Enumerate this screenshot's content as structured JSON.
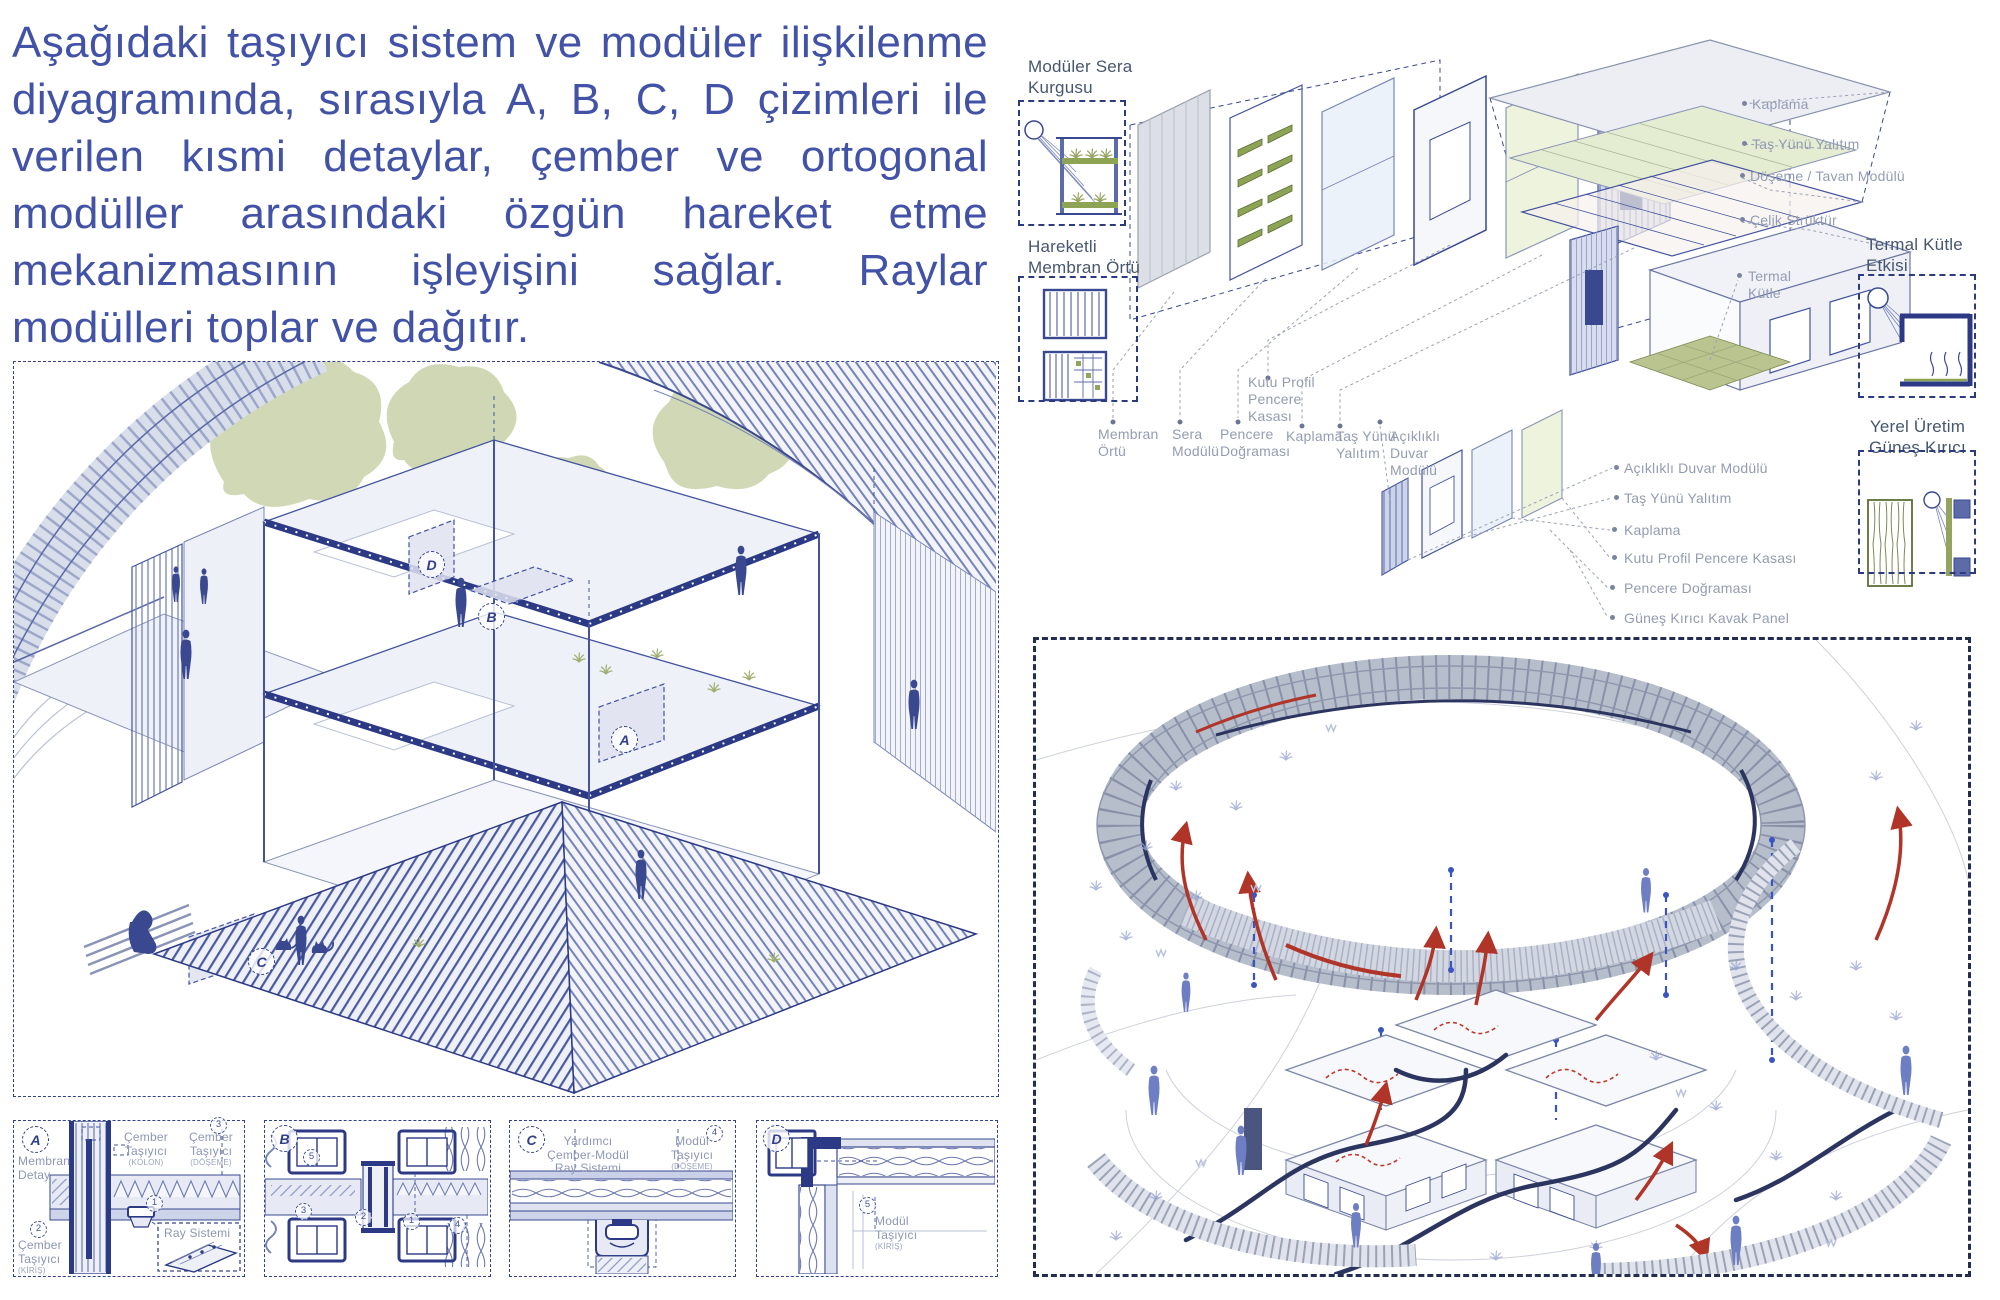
{
  "intro": {
    "text": "Aşağıdaki taşıyıcı sistem ve modüler ilişkilenme diyagramında, sırasıyla A, B, C, D çizimleri ile verilen kısmi detaylar, çember ve ortogonal modüller arasındaki özgün hareket etme mekanizmasının işleyişini sağlar. Raylar modülleri toplar ve dağıtır."
  },
  "left_axo": {
    "markers": {
      "a": "A",
      "b": "B",
      "c": "C",
      "d": "D"
    }
  },
  "detail_numbers": {
    "n1": "1",
    "n2": "2",
    "n3": "3",
    "n4": "4",
    "n5": "5"
  },
  "details": {
    "a": {
      "marker": "A",
      "membran_detay": "Membran Detay",
      "cember": "Çember Taşıyıcı",
      "sub_kolon": "(KOLON)",
      "sub_doseme": "(DÖŞEME)",
      "sub_kiris": "(KİRİŞ)",
      "ray_sistemi": "Ray Sistemi"
    },
    "b": {
      "marker": "B"
    },
    "c": {
      "marker": "C",
      "yardimci": "Yardımcı Çember-Modül Ray Sistemi",
      "modul": "Modül Taşıyıcı",
      "sub_doseme": "(DÖŞEME)"
    },
    "d": {
      "marker": "D",
      "modul": "Modül Taşıyıcı",
      "sub_kiris": "(KİRİŞ)"
    }
  },
  "exploded": {
    "box_sera_title": "Modüler Sera Kurgusu",
    "box_membran_title": "Hareketli Membran Örtü",
    "box_termal_title": "Termal Kütle Etkisi",
    "box_yerel_title": "Yerel Üretim Güneş Kırıcı",
    "bottom_labels": {
      "membran": "Membran Örtü",
      "sera": "Sera Modülü",
      "pencere": "Pencere Doğraması",
      "kutu": "Kutu Profil Pencere Kasası",
      "kaplama": "Kaplama",
      "tas": "Taş Yünü Yalıtım",
      "acikli": "Açıklıklı Duvar Modülü"
    },
    "right_labels": [
      "Kaplama",
      "Taş Yünü Yalıtım",
      "Döşeme / Tavan Modülü",
      "Çelik Strüktür",
      "Termal Kütle"
    ],
    "list_labels": [
      "Açıklıklı Duvar Modülü",
      "Taş Yünü Yalıtım",
      "Kaplama",
      "Kutu Profil Pencere Kasası",
      "Pencere Doğraması",
      "Güneş Kırıcı Kavak Panel"
    ]
  },
  "colors": {
    "text_blue": "#4152a7",
    "line_navy": "#2e3a87",
    "label_gray": "#939cb2",
    "heading_slate": "#47566f",
    "vegetation_green": "#a9b878",
    "arrow_red": "#b03427",
    "ring_gray": "#aeb5c6"
  }
}
